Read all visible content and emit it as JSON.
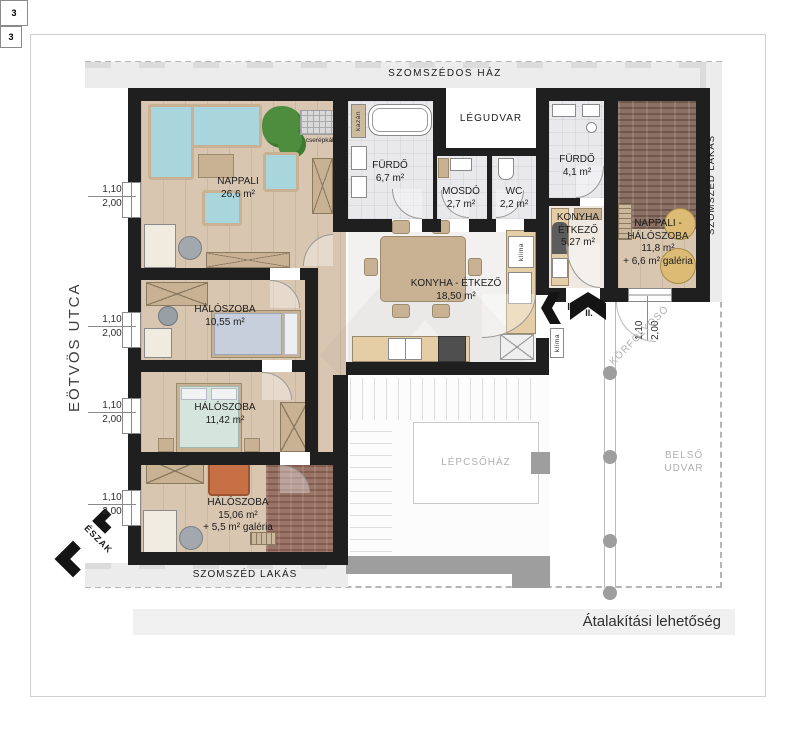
{
  "page": {
    "title": "Átalakítási lehetőség"
  },
  "context": {
    "street": "EÖTVÖS UTCA",
    "north": "ÉSZAK",
    "neighbor_top": "SZOMSZÉDOS HÁZ",
    "neighbor_right": "SZOMSZÉD LAKÁS",
    "neighbor_bottom": "SZOMSZÉD LAKÁS",
    "corridor": "KÖRFOLYOSÓ",
    "stairwell": "LÉPCSŐHÁZ",
    "courtyard_line1": "BELSŐ",
    "courtyard_line2": "UDVAR"
  },
  "rooms": {
    "nappali": {
      "name": "NAPPALI",
      "area": "26,6 m²"
    },
    "furdo1": {
      "name": "FÜRDŐ",
      "area": "6,7 m²"
    },
    "mosdo": {
      "name": "MOSDÓ",
      "area": "2,7 m²"
    },
    "wc": {
      "name": "WC",
      "area": "2,2 m²"
    },
    "legudvar": {
      "name": "LÉGUDVAR"
    },
    "furdo2": {
      "name": "FÜRDŐ",
      "area": "4,1 m²"
    },
    "konyha_kis": {
      "name_line1": "KONYHA",
      "name_line2": "ÉTKEZŐ",
      "area": "5,27 m²"
    },
    "konyha_nagy": {
      "name": "KONYHA - ÉTKEZŐ",
      "area": "18,50 m²"
    },
    "halo1": {
      "name": "HÁLÓSZOBA",
      "area": "10,55 m²"
    },
    "halo2": {
      "name": "HÁLÓSZOBA",
      "area": "11,42 m²"
    },
    "halo3": {
      "name": "HÁLÓSZOBA",
      "area": "15,06 m²",
      "gallery": "+ 5,5 m² galéria"
    },
    "nappali_halo": {
      "name_line1": "NAPPALI -",
      "name_line2": "HÁLÓSZOBA",
      "area": "11,8 m²",
      "gallery": "+ 6,6 m² galéria"
    }
  },
  "annotations": {
    "cserepkalyha": "cserépkályha",
    "kazan": "kazán",
    "klima": "klíma",
    "washer_mark": "3",
    "entry_one": "I.",
    "entry_two": "II.",
    "window_width": "1,10",
    "window_height": "2,00"
  },
  "colors": {
    "wall": "#1f1f1f",
    "wood_floor": "#d9c6b1",
    "tile_floor": "#e9e9ec",
    "kitchen_floor": "#f2f1ef",
    "carpet_dark": "#8b7164",
    "carpet_red": "#9a7466",
    "sofa": "#a9d6dc",
    "furniture_tan": "#c9b294",
    "accent_orange": "#c76f45",
    "neighbor_band": "#ececec",
    "gray_wall": "#9e9e9e"
  }
}
